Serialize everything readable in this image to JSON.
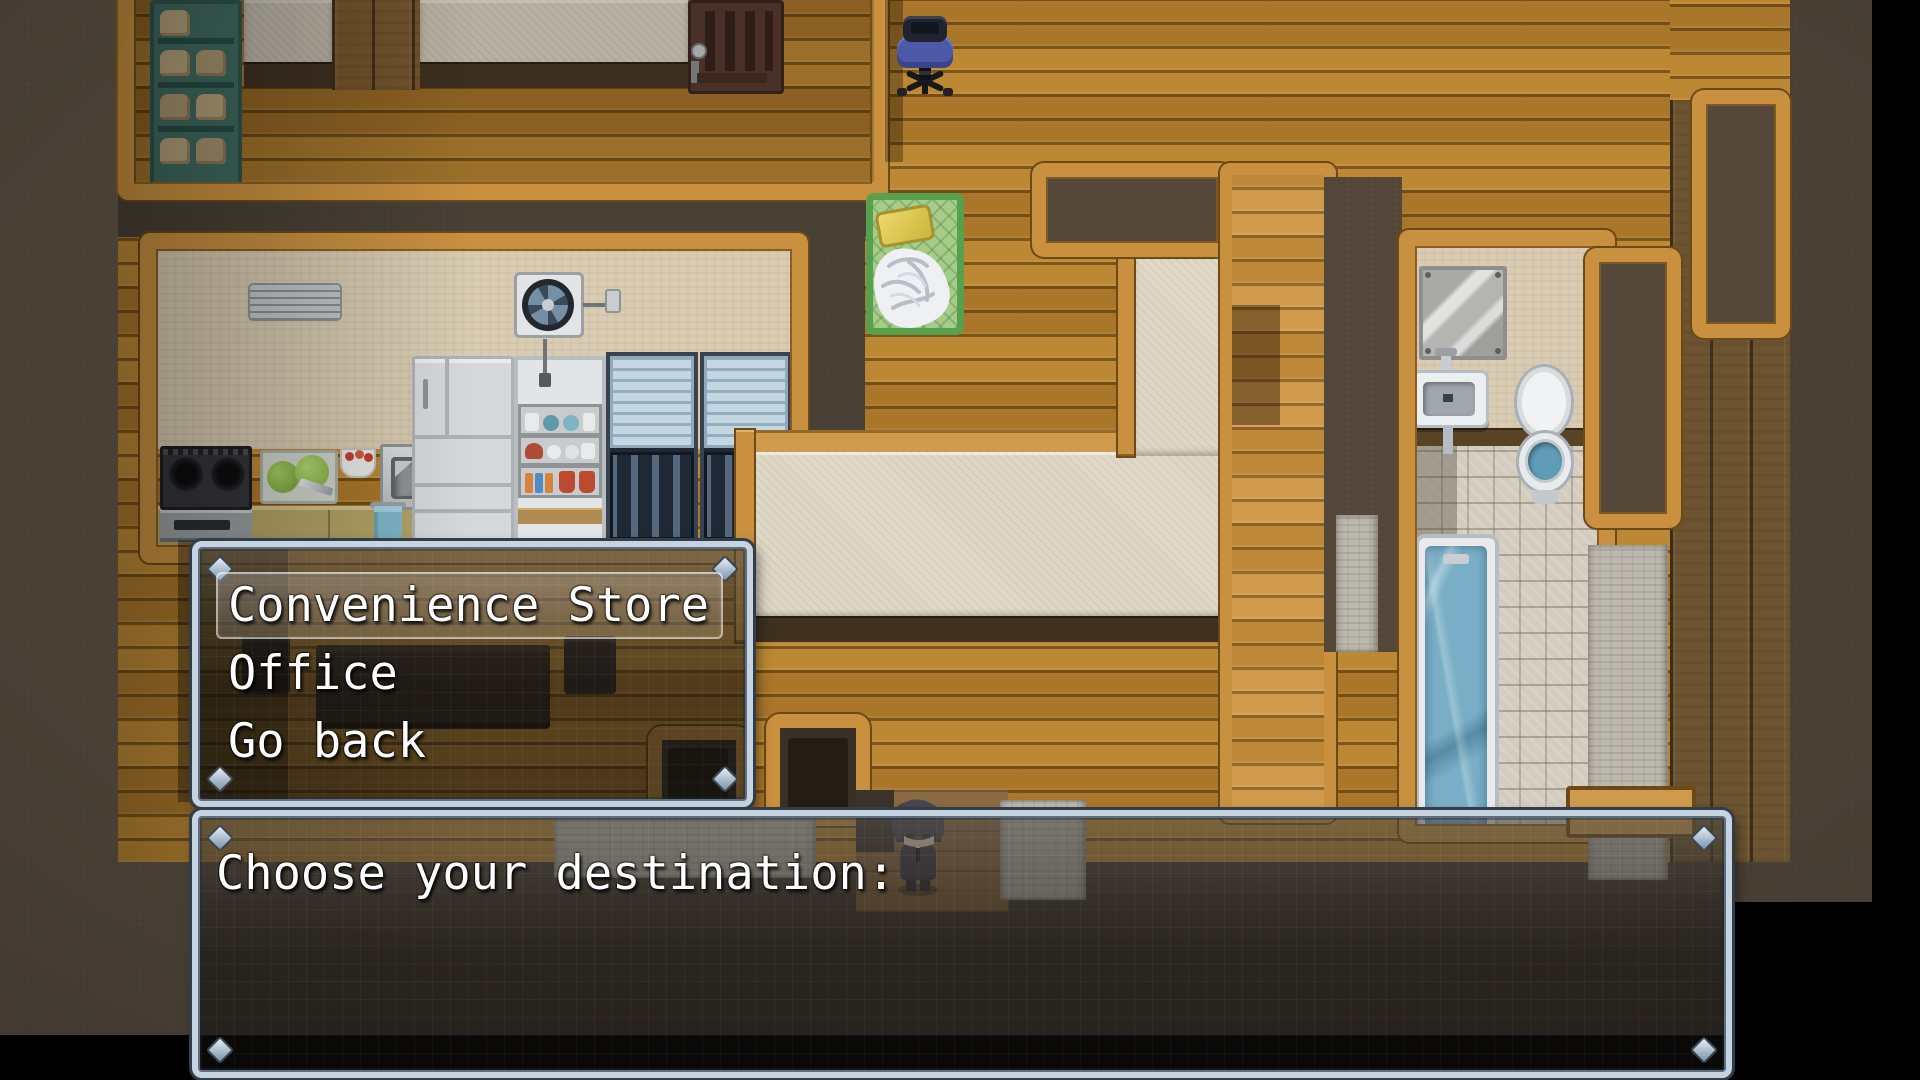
{
  "message_window": {
    "text": "Choose your destination:"
  },
  "choice_window": {
    "selected_index": 0,
    "choices": [
      "Convenience Store",
      "Office",
      "Go back"
    ]
  },
  "palette": {
    "window_frame": "#c6d3e1",
    "window_frame_edge": "#323d49",
    "window_fill": "rgba(22,20,18,0.52)",
    "wood_floor": "#b5812f",
    "wood_border": "#c9903f",
    "wall_dark": "#55483b",
    "field_brown": "#4a4136",
    "cream": "#e0d8c7",
    "beige_wall": "#d9ccb2",
    "tile_floor": "#d3ccbf",
    "water_blue": "#79aec6",
    "bed_green": "#57a14e",
    "pillow_yellow": "#e3cd55",
    "chair_blue": "#4d5aa8"
  },
  "map": {
    "items": [
      "bread-shelf",
      "brewing-machine",
      "office-chair",
      "bed",
      "air-conditioner",
      "ventilation-fan",
      "stove",
      "cutting-board",
      "food-bowl",
      "kitchen-sink",
      "hand-towel",
      "refrigerator",
      "dish-shelf",
      "display-cabinet",
      "counter-slab",
      "dining-table",
      "doorway",
      "bathroom-mirror",
      "bathroom-sink",
      "toilet",
      "bathtub",
      "player-character"
    ]
  }
}
